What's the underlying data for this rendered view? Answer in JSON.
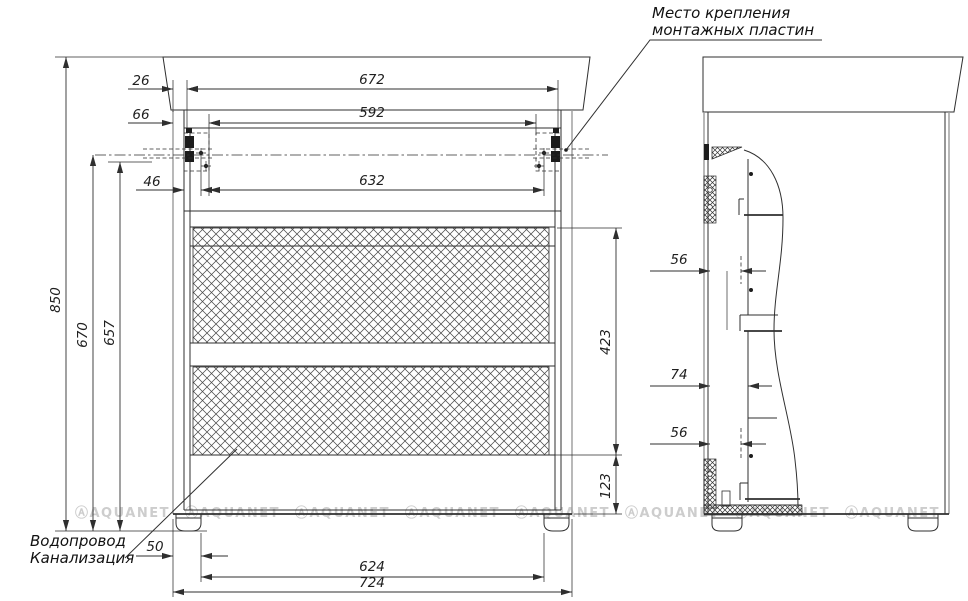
{
  "annotations": {
    "mounting_plates": {
      "line1": "Место крепления",
      "line2": "монтажных пластин"
    },
    "plumbing": {
      "line1": "Водопровод",
      "line2": "Канализация"
    }
  },
  "front_dims": {
    "countertop_side_offset": "26",
    "inner_width_top": "672",
    "plate_edge_offset": "66",
    "plate_span": "592",
    "plate_rail_offset": "46",
    "mount_hole_span": "632",
    "overall_height": "850",
    "mount_axis_height": "670",
    "plate_bottom_height": "657",
    "drawer_zone_height": "423",
    "bottom_gap_height": "123",
    "foot_inset": "50",
    "feet_inner_span": "624",
    "overall_width": "724"
  },
  "side_dims": {
    "upper_inset": "56",
    "middle_inset": "74",
    "lower_inset": "56"
  },
  "watermark": {
    "display": "ⒶAQUANET",
    "color": "#cdcdcd"
  },
  "colors": {
    "background": "#ffffff",
    "line": "#2f2f2f",
    "secondary_line": "#9b9b9b"
  }
}
